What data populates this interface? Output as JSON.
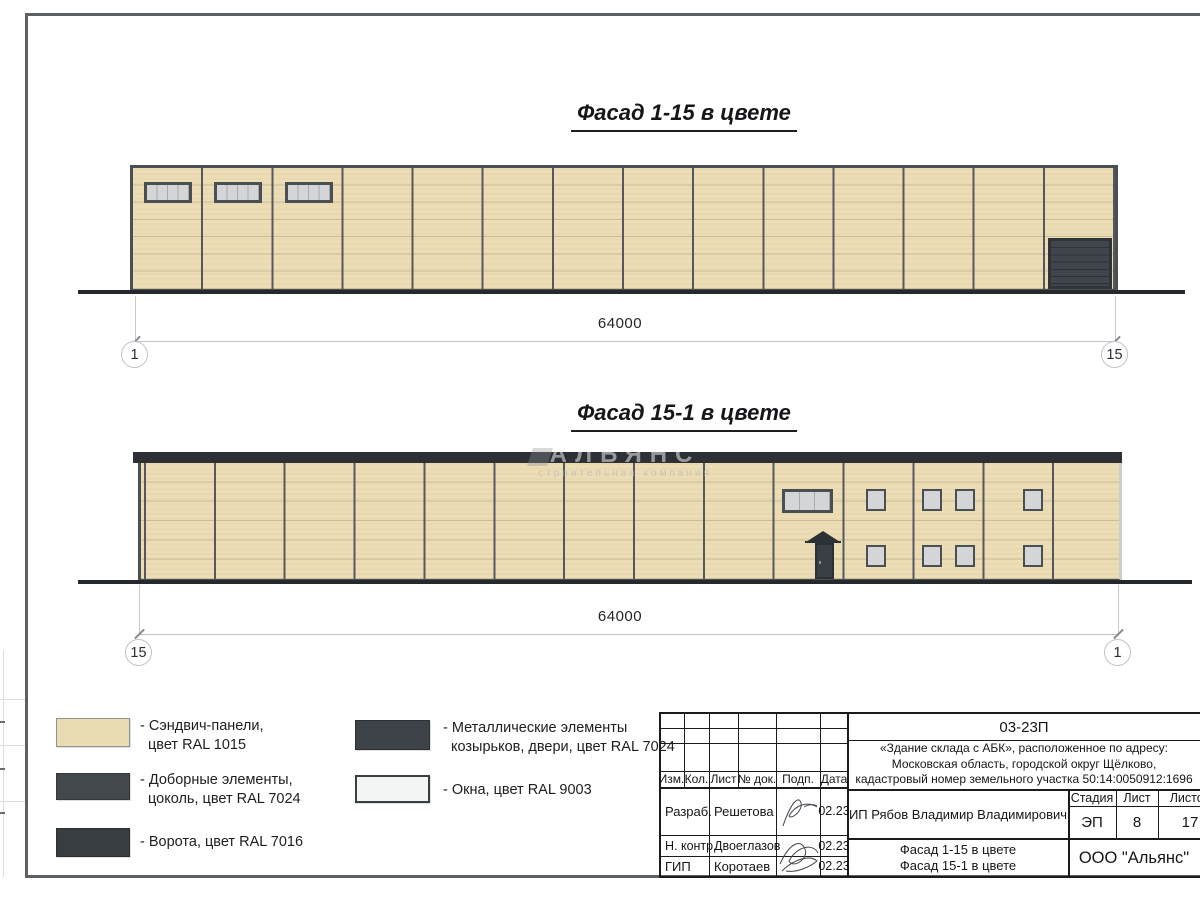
{
  "colors": {
    "panel": "#ecddb5",
    "panel-line": "#c9bc97",
    "frame-dark": "#4a4f54",
    "mullion": "#55595e",
    "band-dark": "#2d3135",
    "gate": "#41464c",
    "gate-line": "#2e3338",
    "glass": "#d4d5d6",
    "ground": "#26292c",
    "dim": "#bfc3c6",
    "axis-ring": "#bdc2c6",
    "door": "#3a3f45",
    "white-trim": "#c9cdd0"
  },
  "facade1": {
    "title": "Фасад 1-15 в цвете",
    "dimension": "64000",
    "axis_left": "1",
    "axis_right": "15"
  },
  "facade2": {
    "title": "Фасад 15-1 в цвете",
    "dimension": "64000",
    "axis_left": "15",
    "axis_right": "1"
  },
  "watermark": {
    "line1": "АЛЬЯНС",
    "line2": "строительная компания"
  },
  "legend": {
    "items": [
      {
        "line1": "- Сэндвич-панели,",
        "line2": "цвет RAL 1015",
        "color": "#e9dcb2"
      },
      {
        "line1": "- Доборные элементы,",
        "line2": "цоколь, цвет RAL 7024",
        "color": "#43484d"
      },
      {
        "line1": "- Ворота, цвет RAL 7016",
        "line2": "",
        "color": "#383d42"
      },
      {
        "line1": "- Металлические элементы",
        "line2": "козырьков, двери, цвет RAL 7024",
        "color": "#3e4349"
      },
      {
        "line1": "- Окна, цвет RAL 9003",
        "line2": "",
        "color": "#f3f4f4"
      }
    ]
  },
  "titleblock": {
    "doc_number": "03-23П",
    "project_line1": "«Здание склада с АБК», расположенное по адресу:",
    "project_line2": "Московская область, городской округ Щёлково,",
    "project_line3": "кадастровый номер земельного участка 50:14:0050912:1696",
    "col_izm": "Изм.",
    "col_kol": "Кол.",
    "col_list": "Лист",
    "col_ndok": "№ док.",
    "col_podp": "Подп.",
    "col_data": "Дата",
    "row1_role": "Разраб.",
    "row1_name": "Решетова",
    "row1_date": "02.23",
    "row2_role": "Н. контр.",
    "row2_name": "Двоеглазов",
    "row2_date": "02.23",
    "row3_role": "ГИП",
    "row3_name": "Коротаев",
    "row3_date": "02.23",
    "client": "ИП Рябов Владимир Владимирович",
    "stage_label": "Стадия",
    "sheet_label": "Лист",
    "sheets_label": "Листов",
    "stage": "ЭП",
    "sheet": "8",
    "sheets": "17",
    "drawing_title1": "Фасад 1-15 в цвете",
    "drawing_title2": "Фасад 15-1 в цвете",
    "company": "ООО \"Альянс\""
  }
}
